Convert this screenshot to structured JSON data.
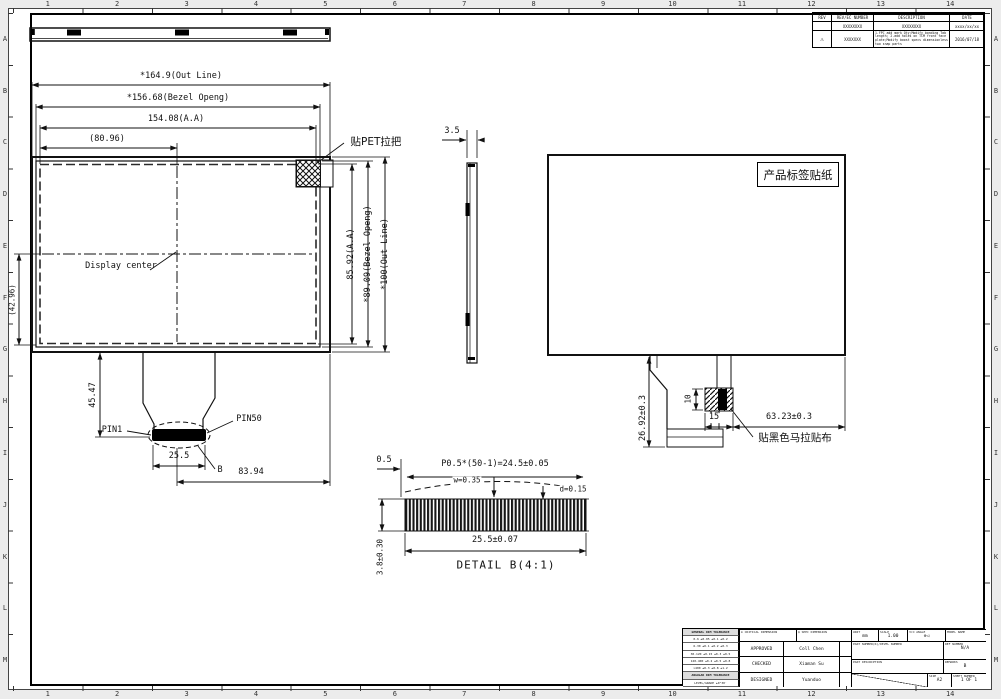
{
  "frame": {
    "cols": [
      "1",
      "2",
      "3",
      "4",
      "5",
      "6",
      "7",
      "8",
      "9",
      "10",
      "11",
      "12",
      "13",
      "14"
    ],
    "rows": [
      "A",
      "B",
      "C",
      "D",
      "E",
      "F",
      "G",
      "H",
      "I",
      "J",
      "K",
      "L",
      "M"
    ]
  },
  "front": {
    "dim_out_w": "*164.9(Out Line)",
    "dim_bezel_w": "*156.68(Bezel Openg)",
    "dim_aa_w": "154.08(A.A)",
    "dim_half_w": "(80.96)",
    "dim_aa_h": "85.92(A.A)",
    "dim_bezel_h": "*89.09(Bezel Openg)",
    "dim_out_h": "*100(Out Line)",
    "dim_half_h": "(42.96)",
    "dim_fpc_drop": "45.47",
    "dim_conn_w": "25.5",
    "dim_conn_off": "83.94",
    "label_pet": "贴PET拉把",
    "label_center": "Display center",
    "label_pin1": "PIN1",
    "label_pin50": "PIN50",
    "label_detail": "B"
  },
  "side": {
    "dim_thickness": "3.5"
  },
  "back": {
    "label_sticker": "产品标签贴纸",
    "label_mylar": "贴黑色马拉贴布",
    "dim_drop": "26.92±0.3",
    "dim_tape_h": "10",
    "dim_tape_w": "15",
    "dim_tape_off": "63.23±0.3"
  },
  "detail_b": {
    "title": "DETAIL B(4:1)",
    "dim_lead": "0.5",
    "dim_pitch": "P0.5*(50-1)=24.5±0.05",
    "dim_w": "w=0.35",
    "dim_d": "d=0.15",
    "dim_width": "25.5±0.07",
    "dim_thick": "3.8±0.30"
  },
  "revision_table": {
    "headers": [
      "REV",
      "REV/EC NUMBER",
      "DESCRIPTION",
      "DATE"
    ],
    "rows": [
      {
        "rev": "",
        "number": "XXXXXXXX",
        "description": "XXXXXXXX",
        "date": "xxxx/xx/xx"
      },
      {
        "rev": "⚠",
        "number": "XXXXXXX",
        "description": "1.FPC add mark Qty;Modify bonding Tab length; 2.add holes on TCM front face plate;Modify boost specs dimensionless two snap parts",
        "date": "2016/07/18"
      }
    ]
  },
  "title_block": {
    "tol_rows": [
      "GENERAL DIM TOLERANCE",
      "0-6  ±0.05 ±0.1 ±0.2",
      "6-30  ±0.1 ±0.2 ±0.3",
      "30-120 ±0.15 ±0.3 ±0.5",
      "120-400 ±0.2 ±0.5 ±0.8",
      ">400  ±0.3 ±0.8 ±1.2",
      "ANGULAR DIM TOLERANCE",
      "LEVEL/GRADE  ±0°30′"
    ],
    "critical_dim": "⊕ CRITICAL DIMENSION",
    "spec_dim": "◎ SPEC DIMENSION",
    "approved_label": "APPROVED",
    "approved": "Coll Chen",
    "checked_label": "CHECKED",
    "checked": "Xiaman Su",
    "designed_label": "DESIGNED",
    "designed": "Yuanduo",
    "unit_label": "UNIT",
    "unit": "mm",
    "scale_label": "SCALE",
    "scale": "1.00",
    "angle_label": "3rd ANGLE",
    "angle_symbol": "⊕◁",
    "model_label": "MODEL NAME",
    "part_number_label": "PART NUMBER(R)/DEVEL NUMBER",
    "ref_label": "REF NUMBER",
    "ref": "N/A",
    "part_desc_label": "PART DESCRIPTION",
    "remarks_label": "REMARKS",
    "remarks": "B",
    "size_label": "SIZE",
    "size": "A2",
    "sheet_label": "SHEET NUMBER",
    "sheet": "1 OF 1"
  }
}
